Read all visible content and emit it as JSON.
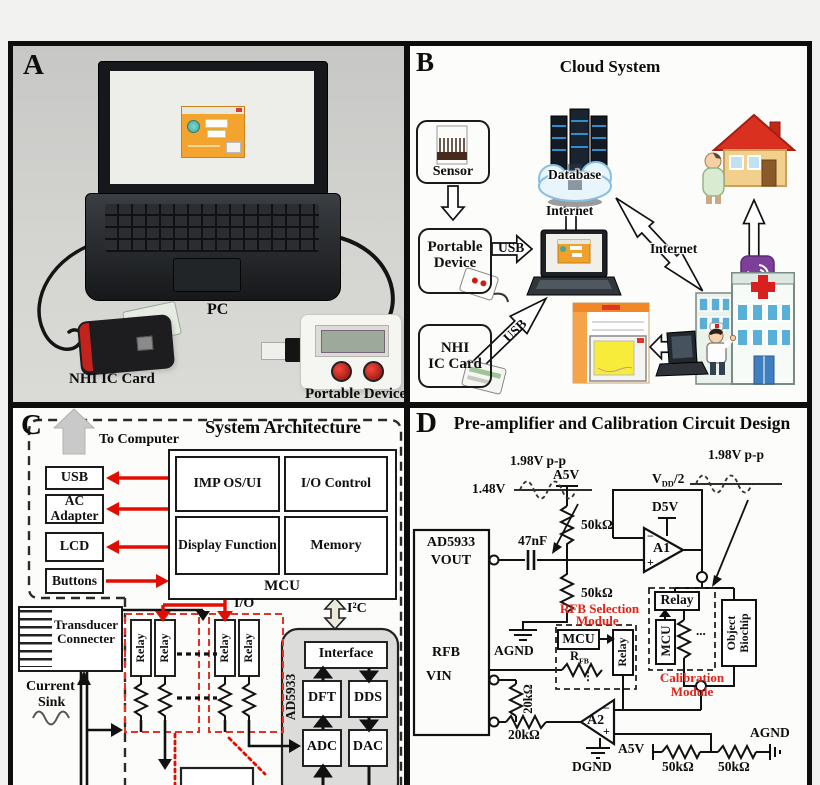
{
  "panel_a": {
    "letter": "A",
    "pc_label": "PC",
    "nhi_card_label": "NHI  IC Card",
    "portable_label": "Portable Device"
  },
  "panel_b": {
    "letter": "B",
    "title": "Cloud System",
    "sensor_label": "Sensor",
    "portable_line1": "Portable",
    "portable_line2": "Device",
    "usb_arrow_label": "USB",
    "usb_diag_label": "USB",
    "nhi_line1": "NHI",
    "nhi_line2": "IC Card",
    "database_label": "Database",
    "internet_vertical_label": "Internet",
    "internet_diagonal_label": "Internet"
  },
  "panel_c": {
    "letter": "C",
    "title": "System Architecture",
    "to_computer": "To Computer",
    "usb": "USB",
    "ac_adapter": "AC Adapter",
    "lcd": "LCD",
    "buttons": "Buttons",
    "imp_os_ui": "IMP OS/UI",
    "io_control": "I/O Control",
    "display_function": "Display Function",
    "memory": "Memory",
    "mcu": "MCU",
    "io": "I/O",
    "i2c": "I²C",
    "transducer_line1": "Transducer",
    "transducer_line2": "Connecter",
    "current_line1": "Current",
    "current_line2": "Sink",
    "relay": "Relay",
    "ad5933": "AD5933",
    "interface": "Interface",
    "dft": "DFT",
    "dds": "DDS",
    "adc": "ADC",
    "dac": "DAC"
  },
  "panel_d": {
    "letter": "D",
    "title": "Pre-amplifier and Calibration Circuit  Design",
    "vpp": "1.98V p-p",
    "v148": "1.48V",
    "a5v": "A5V",
    "c47nf": "47nF",
    "r50k": "50kΩ",
    "r20k": "20kΩ",
    "v_base": "V",
    "v_sub": "DD",
    "v_rest": "/2",
    "d5v": "D5V",
    "a1": "A1",
    "a2": "A2",
    "chip": "AD5933",
    "vout": "VOUT",
    "rfb": "RFB",
    "vin": "VIN",
    "agnd": "AGND",
    "dgnd": "DGND",
    "rfb_module_line1": "RFB Selection",
    "rfb_module_line2": "Module",
    "calibration_module": "Calibration Module",
    "mcu": "MCU",
    "relay": "Relay",
    "r_base": "R",
    "r_sub": "FB",
    "hdots": "...",
    "vdots": "⋮",
    "biochip_line1": "Object",
    "biochip_line2": "Biochip",
    "minus": "−",
    "plus": "+"
  }
}
